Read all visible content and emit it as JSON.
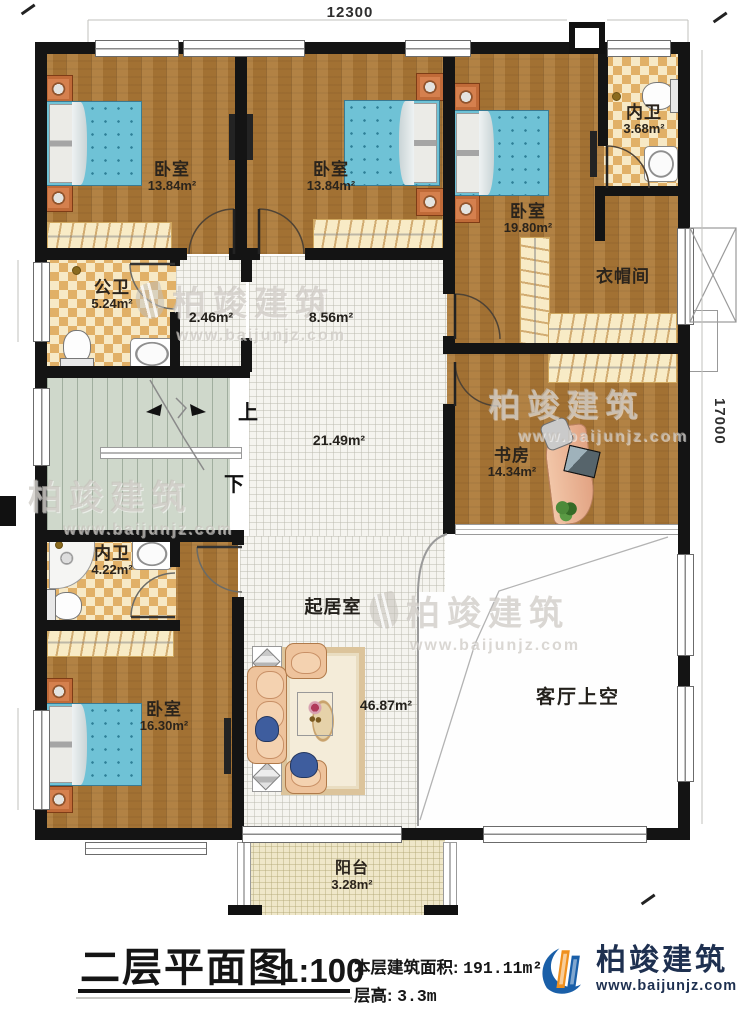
{
  "plan": {
    "dim_top": "12300",
    "dim_right": "17000",
    "rooms": {
      "bedroom_a": {
        "label": "卧室",
        "area": "13.84m²"
      },
      "bedroom_b": {
        "label": "卧室",
        "area": "13.84m²"
      },
      "bedroom_c": {
        "label": "卧室",
        "area": "19.80m²"
      },
      "ensuite_top": {
        "label": "内卫",
        "area": "3.68m²"
      },
      "cloakroom": {
        "label": "衣帽间"
      },
      "public_bath": {
        "label": "公卫",
        "area": "5.24m²"
      },
      "hall_small": {
        "area": "2.46m²"
      },
      "corridor": {
        "area": "8.56m²"
      },
      "hall": {
        "area": "21.49m²"
      },
      "stair_up": "上",
      "stair_down": "下",
      "study": {
        "label": "书房",
        "area": "14.34m²"
      },
      "ensuite_bottom": {
        "label": "内卫",
        "area": "4.22m²"
      },
      "bedroom_d": {
        "label": "卧室",
        "area": "16.30m²"
      },
      "living": {
        "label": "起居室",
        "area": "46.87m²"
      },
      "living_void": {
        "label": "客厅上空"
      },
      "balcony": {
        "label": "阳台",
        "area": "3.28m²"
      }
    },
    "watermark": {
      "brand": "柏竣建筑",
      "url": "www.baijunjz.com"
    }
  },
  "title_block": {
    "drawing_title": "二层平面图",
    "scale": "1:100",
    "floor_area_label": "本层建筑面积:",
    "floor_area_value": "191.11m²",
    "floor_height_label": "层高:",
    "floor_height_value": "3.3m",
    "brand": "柏竣建筑",
    "brand_url": "www.baijunjz.com"
  }
}
